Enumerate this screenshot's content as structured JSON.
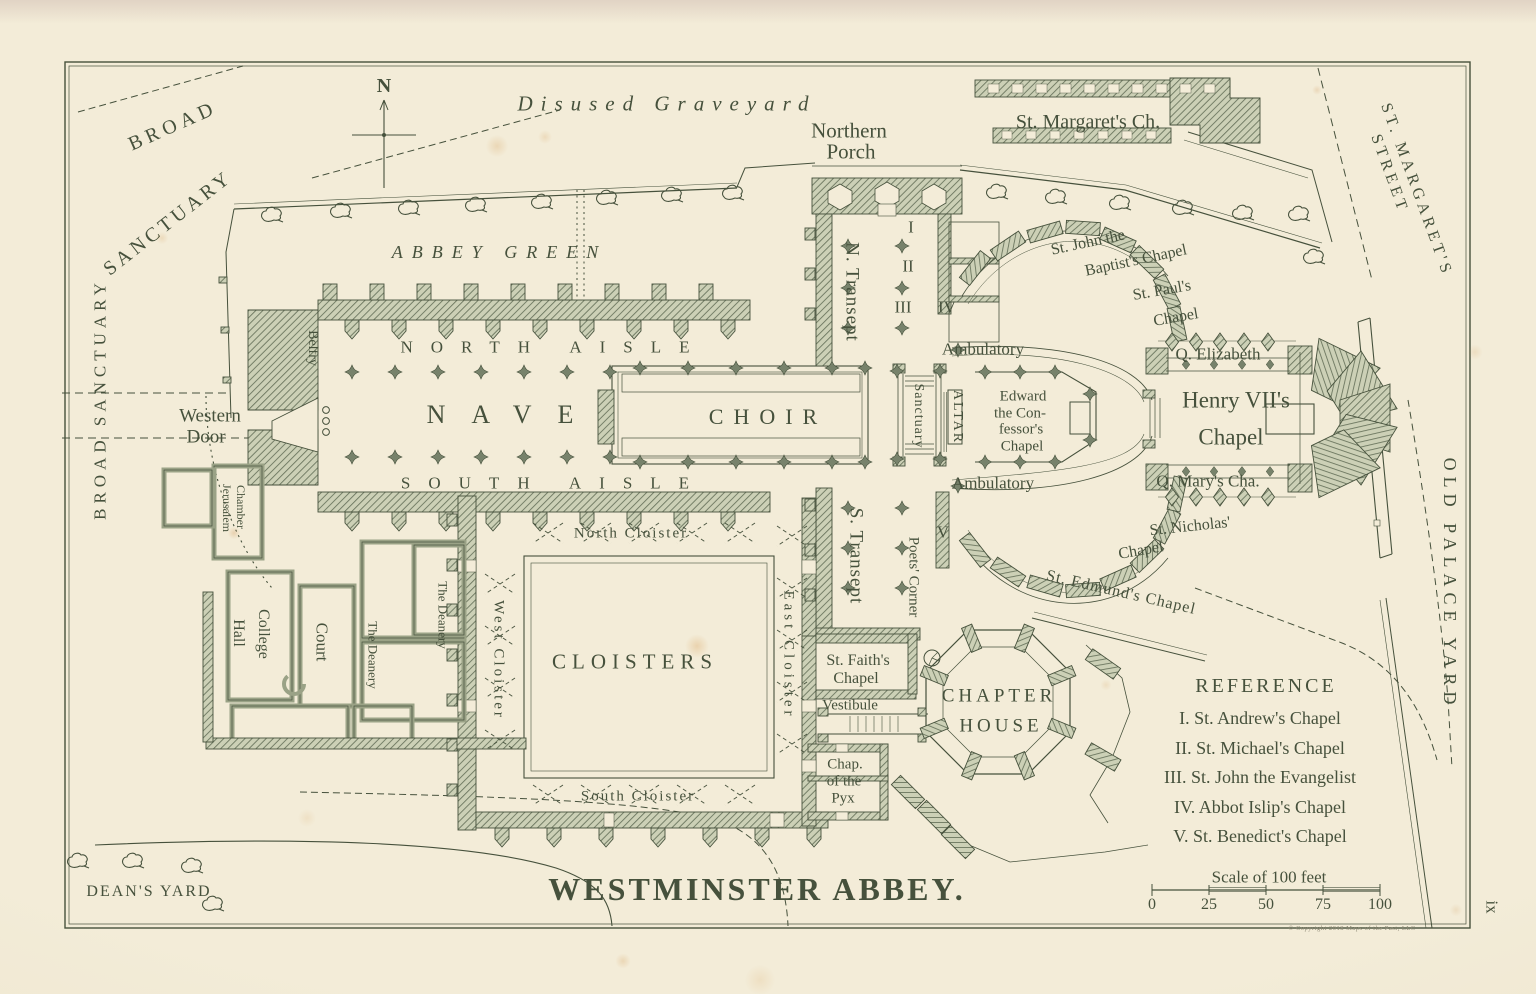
{
  "title": "WESTMINSTER ABBEY.",
  "page_number": "ix",
  "copyright": "© Copyright 2018 Maps of the Past, LLC",
  "compass": {
    "label": "N"
  },
  "reference": {
    "title": "REFERENCE",
    "items": [
      "I. St. Andrew's Chapel",
      "II. St. Michael's Chapel",
      "III. St. John the Evangelist",
      "IV. Abbot Islip's Chapel",
      "V. St. Benedict's Chapel"
    ]
  },
  "scale": {
    "caption": "Scale of 100 feet",
    "ticks": [
      "0",
      "25",
      "50",
      "75",
      "100"
    ]
  },
  "colors": {
    "paper": "#f3ecd8",
    "ink": "#46513c",
    "wall_fill": "#ccd0b6",
    "wall_line": "#66715a",
    "pier_fill": "#77826b"
  },
  "map": {
    "labels": [
      {
        "name": "broad-sanctuary-upper-1",
        "text": "BROAD",
        "x": 170,
        "y": 126,
        "rot": -24,
        "fs": 20,
        "ls": 5
      },
      {
        "name": "broad-sanctuary-upper-2",
        "text": "SANCTUARY",
        "x": 166,
        "y": 223,
        "rot": -38,
        "fs": 20,
        "ls": 4
      },
      {
        "name": "broad-sanctuary-west",
        "text": "BROAD SANCTUARY",
        "x": 97,
        "y": 399,
        "rot": -90,
        "fs": 17,
        "ls": 5
      },
      {
        "name": "disused-graveyard",
        "text": "Disused Graveyard",
        "x": 663,
        "y": 104,
        "rot": 0,
        "fs": 21,
        "ls": 8,
        "it": 1
      },
      {
        "name": "abbey-green",
        "text": "ABBEY GREEN",
        "x": 495,
        "y": 252,
        "rot": 0,
        "fs": 18,
        "ls": 9,
        "it": 1
      },
      {
        "name": "northern-porch-1",
        "text": "Northern",
        "x": 849,
        "y": 131,
        "rot": 0,
        "fs": 21
      },
      {
        "name": "northern-porch-2",
        "text": "Porch",
        "x": 851,
        "y": 152,
        "rot": 0,
        "fs": 21
      },
      {
        "name": "st-margarets-church",
        "text": "St. Margaret's Ch.",
        "x": 1088,
        "y": 122,
        "rot": 0,
        "fs": 20
      },
      {
        "name": "st-margarets-street-1",
        "text": "ST. MARGARET'S",
        "x": 1414,
        "y": 190,
        "rot": 70,
        "fs": 16,
        "ls": 4
      },
      {
        "name": "st-margarets-street-2",
        "text": "STREET",
        "x": 1387,
        "y": 174,
        "rot": 70,
        "fs": 16,
        "ls": 4
      },
      {
        "name": "north-transept",
        "text": "N. Transept",
        "x": 851,
        "y": 292,
        "rot": 90,
        "fs": 19,
        "ls": 1
      },
      {
        "name": "chapel-numeral-i",
        "text": "I",
        "x": 911,
        "y": 227,
        "rot": 0,
        "fs": 17
      },
      {
        "name": "chapel-numeral-ii",
        "text": "II",
        "x": 908,
        "y": 266,
        "rot": 0,
        "fs": 17
      },
      {
        "name": "chapel-numeral-iii",
        "text": "III",
        "x": 903,
        "y": 307,
        "rot": 0,
        "fs": 17
      },
      {
        "name": "chapel-numeral-iv",
        "text": "IV",
        "x": 947,
        "y": 307,
        "rot": 0,
        "fs": 17
      },
      {
        "name": "st-john-baptist-1",
        "text": "St. John the",
        "x": 1088,
        "y": 243,
        "rot": -12,
        "fs": 16
      },
      {
        "name": "st-john-baptist-2",
        "text": "Baptist's Chapel",
        "x": 1136,
        "y": 261,
        "rot": -12,
        "fs": 16
      },
      {
        "name": "st-pauls-1",
        "text": "St. Paul's",
        "x": 1162,
        "y": 291,
        "rot": -10,
        "fs": 16
      },
      {
        "name": "st-pauls-2",
        "text": "Chapel",
        "x": 1176,
        "y": 318,
        "rot": -10,
        "fs": 16
      },
      {
        "name": "q-elizabeth",
        "text": "Q. Elizabeth",
        "x": 1218,
        "y": 354,
        "rot": 0,
        "fs": 17
      },
      {
        "name": "henry-vii-1",
        "text": "Henry VII's",
        "x": 1236,
        "y": 400,
        "rot": 0,
        "fs": 23
      },
      {
        "name": "henry-vii-2",
        "text": "Chapel",
        "x": 1231,
        "y": 437,
        "rot": 0,
        "fs": 23
      },
      {
        "name": "q-marys",
        "text": "Q. Mary's Cha.",
        "x": 1208,
        "y": 481,
        "rot": 0,
        "fs": 17
      },
      {
        "name": "st-nicholas-1",
        "text": "St. Nicholas'",
        "x": 1190,
        "y": 527,
        "rot": -6,
        "fs": 16
      },
      {
        "name": "st-nicholas-2",
        "text": "Chapel",
        "x": 1141,
        "y": 551,
        "rot": -10,
        "fs": 16
      },
      {
        "name": "st-edmunds",
        "text": "St. Edmund's Chapel",
        "x": 1120,
        "y": 593,
        "rot": 13,
        "fs": 16,
        "ls": 1
      },
      {
        "name": "north-aisle",
        "text": "NORTH AISLE",
        "x": 545,
        "y": 347,
        "rot": 0,
        "fs": 17,
        "ls": 18
      },
      {
        "name": "nave",
        "text": "NAVE",
        "x": 500,
        "y": 415,
        "rot": 0,
        "fs": 26,
        "ls": 26
      },
      {
        "name": "south-aisle",
        "text": "SOUTH AISLE",
        "x": 545,
        "y": 483,
        "rot": 0,
        "fs": 17,
        "ls": 18
      },
      {
        "name": "choir",
        "text": "CHOIR",
        "x": 763,
        "y": 417,
        "rot": 0,
        "fs": 22,
        "ls": 10
      },
      {
        "name": "sanctuary",
        "text": "Sanctuary",
        "x": 917,
        "y": 416,
        "rot": 90,
        "fs": 14,
        "ls": 1
      },
      {
        "name": "altar",
        "text": "ALTAR",
        "x": 956,
        "y": 417,
        "rot": 90,
        "fs": 14,
        "ls": 2
      },
      {
        "name": "edward-confessor-1",
        "text": "Edward",
        "x": 1023,
        "y": 397,
        "rot": 0,
        "fs": 15
      },
      {
        "name": "edward-confessor-2",
        "text": "the Con-",
        "x": 1020,
        "y": 414,
        "rot": 0,
        "fs": 15
      },
      {
        "name": "edward-confessor-3",
        "text": "fessor's",
        "x": 1021,
        "y": 430,
        "rot": 0,
        "fs": 15
      },
      {
        "name": "edward-confessor-4",
        "text": "Chapel",
        "x": 1022,
        "y": 447,
        "rot": 0,
        "fs": 15
      },
      {
        "name": "ambulatory-north",
        "text": "Ambulatory",
        "x": 983,
        "y": 349,
        "rot": 0,
        "fs": 17
      },
      {
        "name": "ambulatory-south",
        "text": "Ambulatory",
        "x": 993,
        "y": 483,
        "rot": 0,
        "fs": 17
      },
      {
        "name": "western-door-1",
        "text": "Western",
        "x": 210,
        "y": 416,
        "rot": 0,
        "fs": 19
      },
      {
        "name": "western-door-2",
        "text": "Door",
        "x": 206,
        "y": 437,
        "rot": 0,
        "fs": 19
      },
      {
        "name": "belfry",
        "text": "Belfry",
        "x": 312,
        "y": 348,
        "rot": 90,
        "fs": 14
      },
      {
        "name": "jerusalem-chamber-1",
        "text": "Jerusalem",
        "x": 227,
        "y": 508,
        "rot": 90,
        "fs": 12
      },
      {
        "name": "jerusalem-chamber-2",
        "text": "Chamber",
        "x": 241,
        "y": 507,
        "rot": 90,
        "fs": 12
      },
      {
        "name": "south-transept",
        "text": "S. Transept",
        "x": 855,
        "y": 556,
        "rot": 90,
        "fs": 19,
        "ls": 1
      },
      {
        "name": "poets-corner",
        "text": "Poets' Corner",
        "x": 913,
        "y": 577,
        "rot": 90,
        "fs": 15
      },
      {
        "name": "chapel-numeral-v",
        "text": "V",
        "x": 943,
        "y": 532,
        "rot": 0,
        "fs": 17
      },
      {
        "name": "north-cloister",
        "text": "North Cloister",
        "x": 630,
        "y": 534,
        "rot": 0,
        "fs": 15,
        "ls": 2
      },
      {
        "name": "west-cloister",
        "text": "West Cloister",
        "x": 496,
        "y": 660,
        "rot": 90,
        "fs": 15,
        "ls": 3
      },
      {
        "name": "east-cloister",
        "text": "East Cloister",
        "x": 786,
        "y": 655,
        "rot": 90,
        "fs": 15,
        "ls": 4
      },
      {
        "name": "cloisters",
        "text": "CLOISTERS",
        "x": 632,
        "y": 662,
        "rot": 0,
        "fs": 21,
        "ls": 6
      },
      {
        "name": "south-cloister",
        "text": "South Cloister",
        "x": 637,
        "y": 797,
        "rot": 0,
        "fs": 15,
        "ls": 2
      },
      {
        "name": "the-deanery-upper",
        "text": "The Deanery",
        "x": 443,
        "y": 615,
        "rot": 90,
        "fs": 13
      },
      {
        "name": "the-deanery-lower",
        "text": "The Deanery",
        "x": 373,
        "y": 655,
        "rot": 90,
        "fs": 13
      },
      {
        "name": "college-hall-1",
        "text": "College",
        "x": 263,
        "y": 634,
        "rot": 90,
        "fs": 16
      },
      {
        "name": "college-hall-2",
        "text": "Hall",
        "x": 238,
        "y": 633,
        "rot": 90,
        "fs": 16
      },
      {
        "name": "court",
        "text": "Court",
        "x": 322,
        "y": 642,
        "rot": 90,
        "fs": 17
      },
      {
        "name": "deans-yard",
        "text": "DEAN'S YARD",
        "x": 148,
        "y": 892,
        "rot": 0,
        "fs": 16,
        "ls": 2
      },
      {
        "name": "old-palace-yard",
        "text": "OLD PALACE YARD",
        "x": 1447,
        "y": 584,
        "rot": 90,
        "fs": 18,
        "ls": 6
      },
      {
        "name": "st-faiths-1",
        "text": "St. Faith's",
        "x": 858,
        "y": 661,
        "rot": 0,
        "fs": 16
      },
      {
        "name": "st-faiths-2",
        "text": "Chapel",
        "x": 856,
        "y": 679,
        "rot": 0,
        "fs": 16
      },
      {
        "name": "vestibule",
        "text": "Vestibule",
        "x": 850,
        "y": 706,
        "rot": 0,
        "fs": 15
      },
      {
        "name": "chapel-pyx-1",
        "text": "Chap.",
        "x": 845,
        "y": 765,
        "rot": 0,
        "fs": 15
      },
      {
        "name": "chapel-pyx-2",
        "text": "of the",
        "x": 844,
        "y": 782,
        "rot": 0,
        "fs": 15
      },
      {
        "name": "chapel-pyx-3",
        "text": "Pyx",
        "x": 843,
        "y": 799,
        "rot": 0,
        "fs": 15
      },
      {
        "name": "chapter-house-1",
        "text": "CHAPTER",
        "x": 997,
        "y": 696,
        "rot": 0,
        "fs": 19,
        "ls": 4
      },
      {
        "name": "chapter-house-2",
        "text": "HOUSE",
        "x": 999,
        "y": 726,
        "rot": 0,
        "fs": 19,
        "ls": 4
      }
    ]
  }
}
